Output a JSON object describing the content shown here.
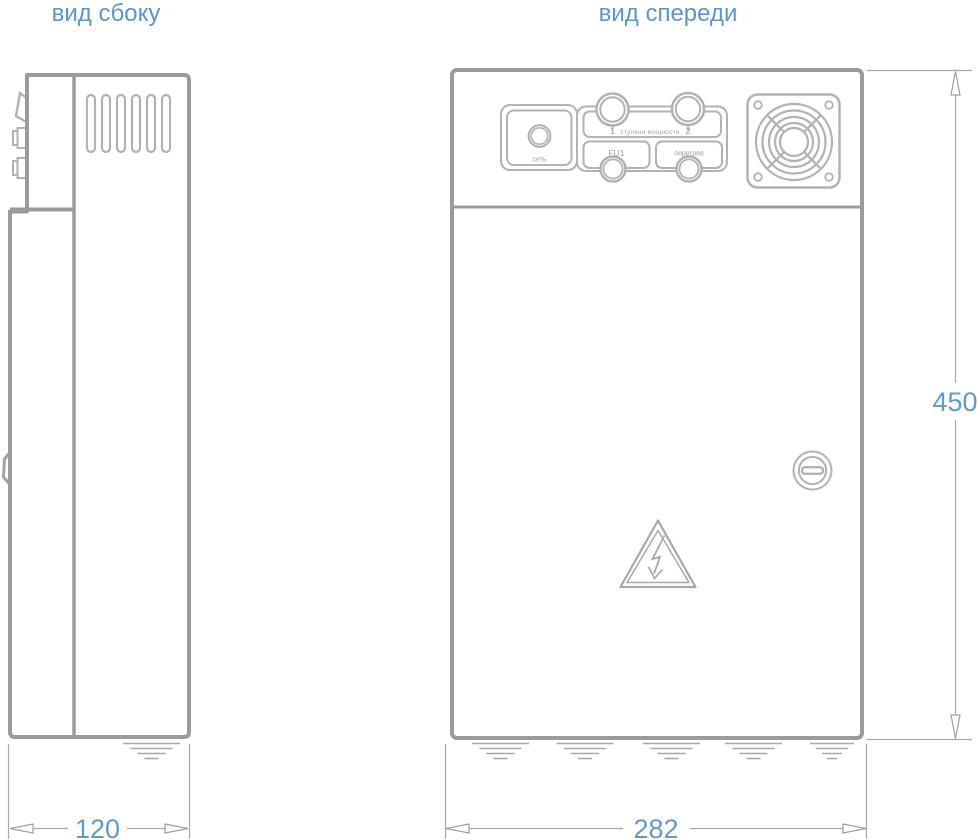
{
  "titles": {
    "side_view": "вид сбоку",
    "front_view": "вид спереди"
  },
  "dimensions": {
    "side_depth_mm": "120",
    "front_width_mm": "282",
    "height_mm": "450"
  },
  "front_panel": {
    "power_indicator_label": "сеть",
    "power_steps_label": "ступени мощности",
    "step_1_label": "1",
    "step_2_label": "2",
    "fuse_label": "FU1",
    "overheat_label": "перегрев"
  },
  "icons": {
    "fan_grille": "fan-grille-icon",
    "lock": "cam-lock-icon",
    "high_voltage": "high-voltage-triangle-icon",
    "ground_hatch": "ground-hatch-icon",
    "power_indicator": "power-indicator-lamp",
    "knob_1": "power-step-knob-1",
    "knob_2": "power-step-knob-2",
    "fuse_holder": "fuse-holder-cap",
    "overheat_indicator": "overheat-indicator-lamp",
    "vents": "vent-slots-icon",
    "door_handle": "door-handle-icon",
    "mount_bracket": "mount-bracket-icon"
  },
  "colors": {
    "outline_gray": "#9b9b9b",
    "detail_gray": "#b2b2b2",
    "dimension_gray": "#a9a9a9",
    "label_gray": "#9e9e9e",
    "title_blue": "#5e96c8",
    "dimension_blue": "#6099cc",
    "background": "#ffffff"
  }
}
